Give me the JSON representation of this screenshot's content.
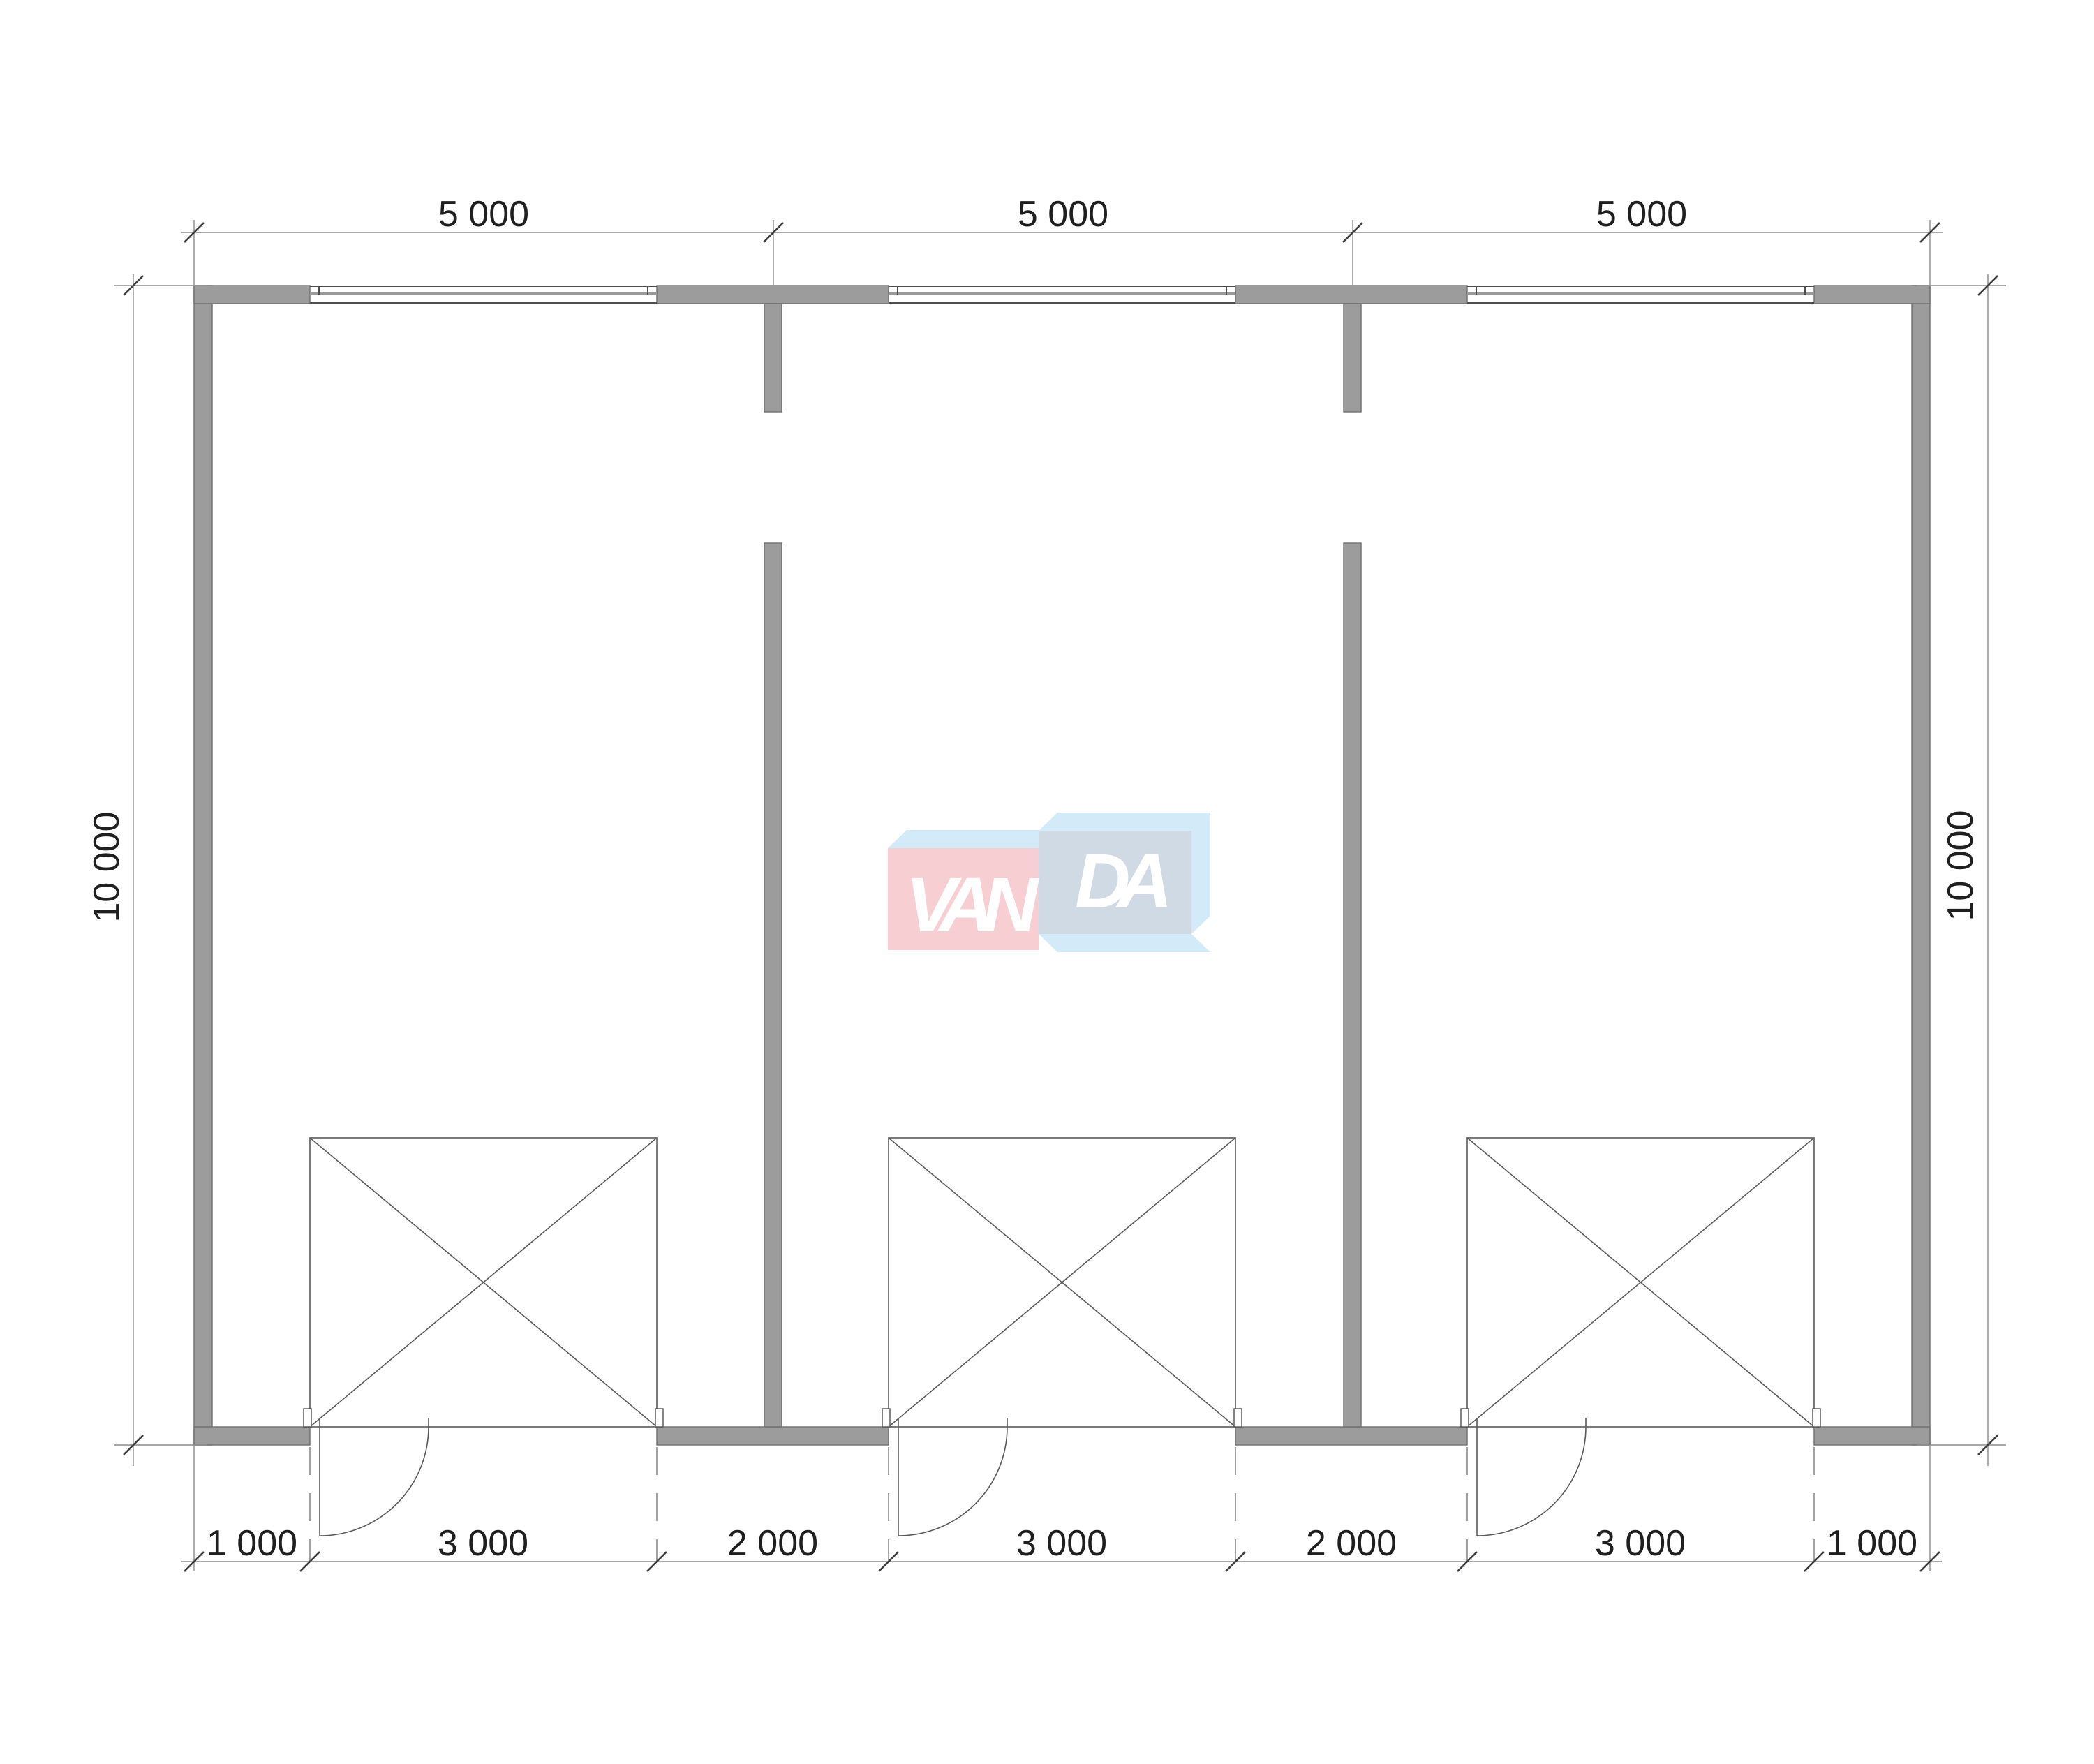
{
  "drawing_type": "floor-plan",
  "dimensions": {
    "top": [
      "5 000",
      "5 000",
      "5 000"
    ],
    "bottom": [
      "1 000",
      "3 000",
      "2 000",
      "3 000",
      "2 000",
      "3 000",
      "1 000"
    ],
    "left": "10 000",
    "right": "10 000"
  },
  "watermark": {
    "part1": "VAN",
    "part2": "DA",
    "colors": {
      "pink_face": "#f7c9ce",
      "light_blue": "#cfe9f8",
      "gray_blue_face": "#ccd6e3",
      "letters": "#ffffff"
    }
  },
  "colors": {
    "background": "#ffffff",
    "wall_fill": "#9c9c9c",
    "wall_edge": "#6f6f6f",
    "object_line": "#4f4f4f",
    "dimension_line": "#8c8c8c",
    "tick_mark": "#3d3d3d",
    "glazing_line": "#9a9a9a",
    "text": "#1f1f1f"
  }
}
